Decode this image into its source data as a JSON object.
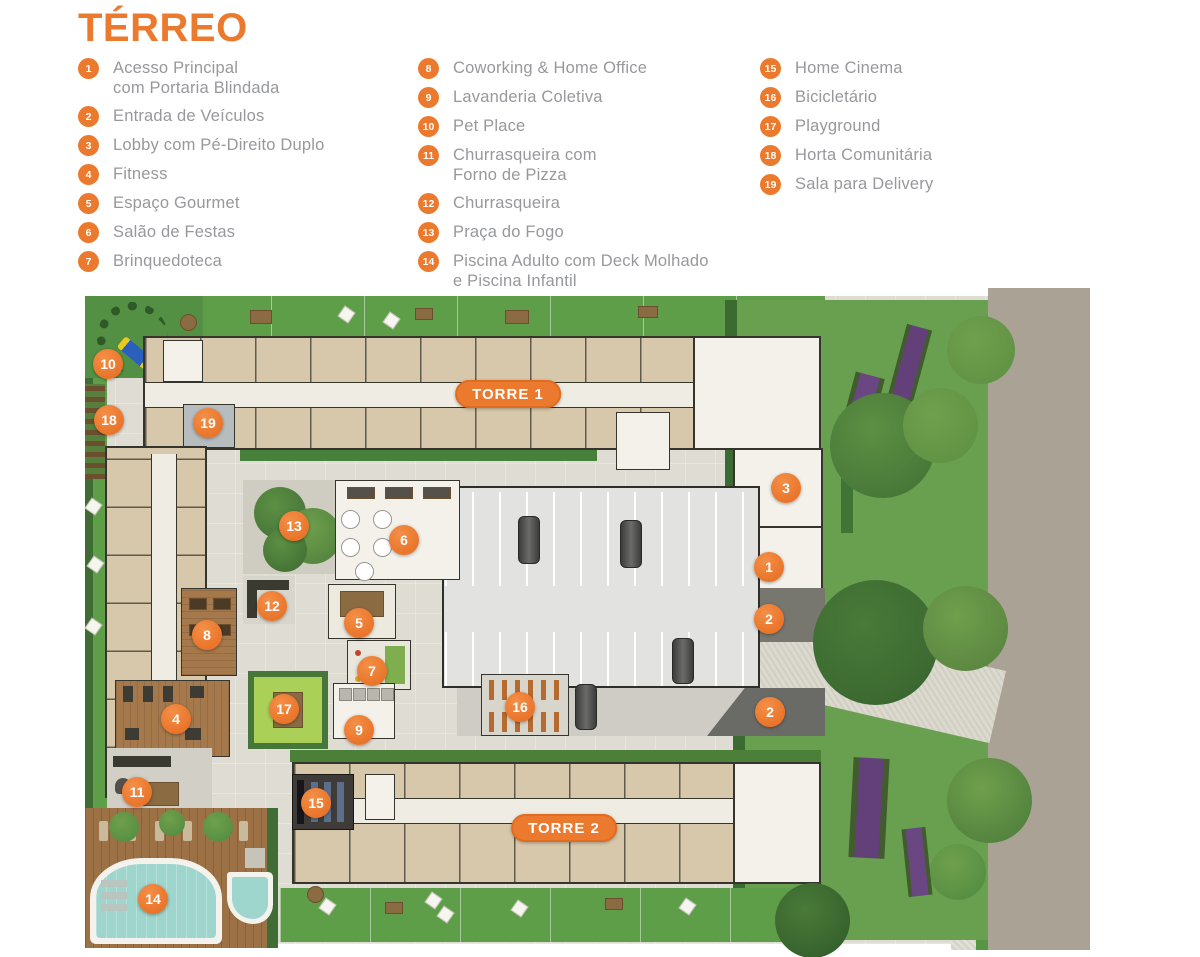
{
  "title": "TÉRREO",
  "colors": {
    "accent_orange": "#EC7A2E",
    "legend_text_gray": "#97989B",
    "grass_green": "#5F9E49",
    "garden_green": "#68A050",
    "building_beige": "#D8C8AB",
    "wall_dark": "#35352D",
    "paving_gray": "#D7D4CB",
    "road_gray": "#A9A295",
    "pool_teal": "#9ED5CC",
    "deck_wood": "#9C7146",
    "playground_green": "#ABD058",
    "flowerbed_purple": "#64407A"
  },
  "legend": {
    "columns": [
      {
        "items": [
          {
            "num": "1",
            "label": "Acesso Principal\ncom Portaria Blindada"
          },
          {
            "num": "2",
            "label": "Entrada de Veículos"
          },
          {
            "num": "3",
            "label": "Lobby com Pé-Direito Duplo"
          },
          {
            "num": "4",
            "label": "Fitness"
          },
          {
            "num": "5",
            "label": "Espaço Gourmet"
          },
          {
            "num": "6",
            "label": "Salão de Festas"
          },
          {
            "num": "7",
            "label": "Brinquedoteca"
          }
        ]
      },
      {
        "items": [
          {
            "num": "8",
            "label": "Coworking & Home Office"
          },
          {
            "num": "9",
            "label": "Lavanderia Coletiva"
          },
          {
            "num": "10",
            "label": "Pet Place"
          },
          {
            "num": "11",
            "label": "Churrasqueira com\nForno de Pizza"
          },
          {
            "num": "12",
            "label": "Churrasqueira",
            "gap_before": true
          },
          {
            "num": "13",
            "label": "Praça do Fogo"
          },
          {
            "num": "14",
            "label": "Piscina Adulto com Deck Molhado\ne Piscina Infantil"
          }
        ]
      },
      {
        "items": [
          {
            "num": "15",
            "label": "Home Cinema"
          },
          {
            "num": "16",
            "label": "Bicicletário"
          },
          {
            "num": "17",
            "label": "Playground",
            "gap_before": true
          },
          {
            "num": "18",
            "label": "Horta Comunitária"
          },
          {
            "num": "19",
            "label": "Sala para Delivery",
            "gap_before": true
          }
        ]
      }
    ]
  },
  "plan": {
    "towers": [
      {
        "label": "TORRE 1",
        "x": 423,
        "y": 106
      },
      {
        "label": "TORRE 2",
        "x": 479,
        "y": 540
      }
    ],
    "markers": [
      {
        "num": "1",
        "x": 684,
        "y": 279
      },
      {
        "num": "2",
        "x": 684,
        "y": 331
      },
      {
        "num": "2",
        "x": 685,
        "y": 424
      },
      {
        "num": "3",
        "x": 701,
        "y": 200
      },
      {
        "num": "4",
        "x": 91,
        "y": 431
      },
      {
        "num": "5",
        "x": 274,
        "y": 335
      },
      {
        "num": "6",
        "x": 319,
        "y": 252
      },
      {
        "num": "7",
        "x": 287,
        "y": 383
      },
      {
        "num": "8",
        "x": 122,
        "y": 347
      },
      {
        "num": "9",
        "x": 274,
        "y": 442
      },
      {
        "num": "10",
        "x": 23,
        "y": 76
      },
      {
        "num": "11",
        "x": 52,
        "y": 504
      },
      {
        "num": "12",
        "x": 187,
        "y": 318
      },
      {
        "num": "13",
        "x": 209,
        "y": 238
      },
      {
        "num": "14",
        "x": 68,
        "y": 611
      },
      {
        "num": "15",
        "x": 231,
        "y": 515
      },
      {
        "num": "16",
        "x": 435,
        "y": 419
      },
      {
        "num": "17",
        "x": 199,
        "y": 421
      },
      {
        "num": "18",
        "x": 24,
        "y": 132
      },
      {
        "num": "19",
        "x": 123,
        "y": 135
      }
    ]
  }
}
